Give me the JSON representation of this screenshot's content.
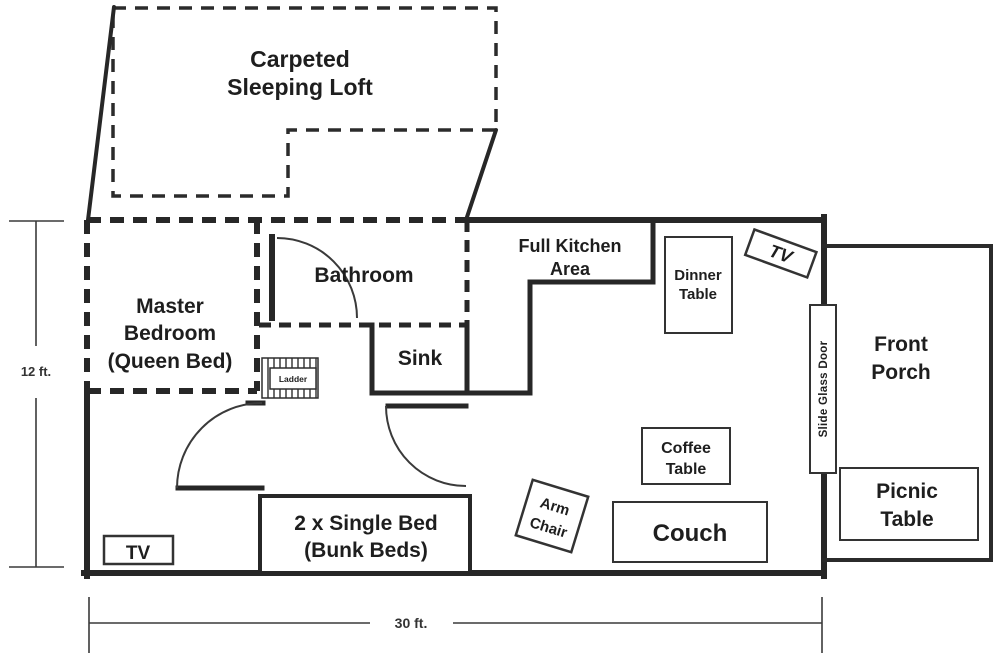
{
  "title": "Cabin floor plan",
  "labels": {
    "loft": {
      "lines": [
        "Carpeted",
        "Sleeping Loft"
      ]
    },
    "master_bedroom": {
      "lines": [
        "Master",
        "Bedroom",
        "(Queen Bed)"
      ]
    },
    "bathroom": {
      "text": "Bathroom"
    },
    "sink": {
      "text": "Sink"
    },
    "ladder": {
      "text": "Ladder"
    },
    "kitchen": {
      "lines": [
        "Full Kitchen",
        "Area"
      ]
    },
    "dinner_table": {
      "lines": [
        "Dinner",
        "Table"
      ]
    },
    "tv_wall": {
      "text": "TV"
    },
    "slide_glass_door": {
      "text": "Slide Glass Door"
    },
    "front_porch": {
      "lines": [
        "Front",
        "Porch"
      ]
    },
    "picnic_table": {
      "lines": [
        "Picnic",
        "Table"
      ]
    },
    "coffee_table": {
      "lines": [
        "Coffee",
        "Table"
      ]
    },
    "arm_chair": {
      "lines": [
        "Arm",
        "Chair"
      ]
    },
    "couch": {
      "text": "Couch"
    },
    "bunk_beds": {
      "lines": [
        "2 x Single Bed",
        "(Bunk Beds)"
      ]
    },
    "tv_living": {
      "text": "TV"
    }
  },
  "dimensions": {
    "height_label": "12 ft.",
    "width_label": "30 ft."
  },
  "colors": {
    "wall": "#272727",
    "text": "#1e1e1e",
    "background": "#ffffff"
  }
}
